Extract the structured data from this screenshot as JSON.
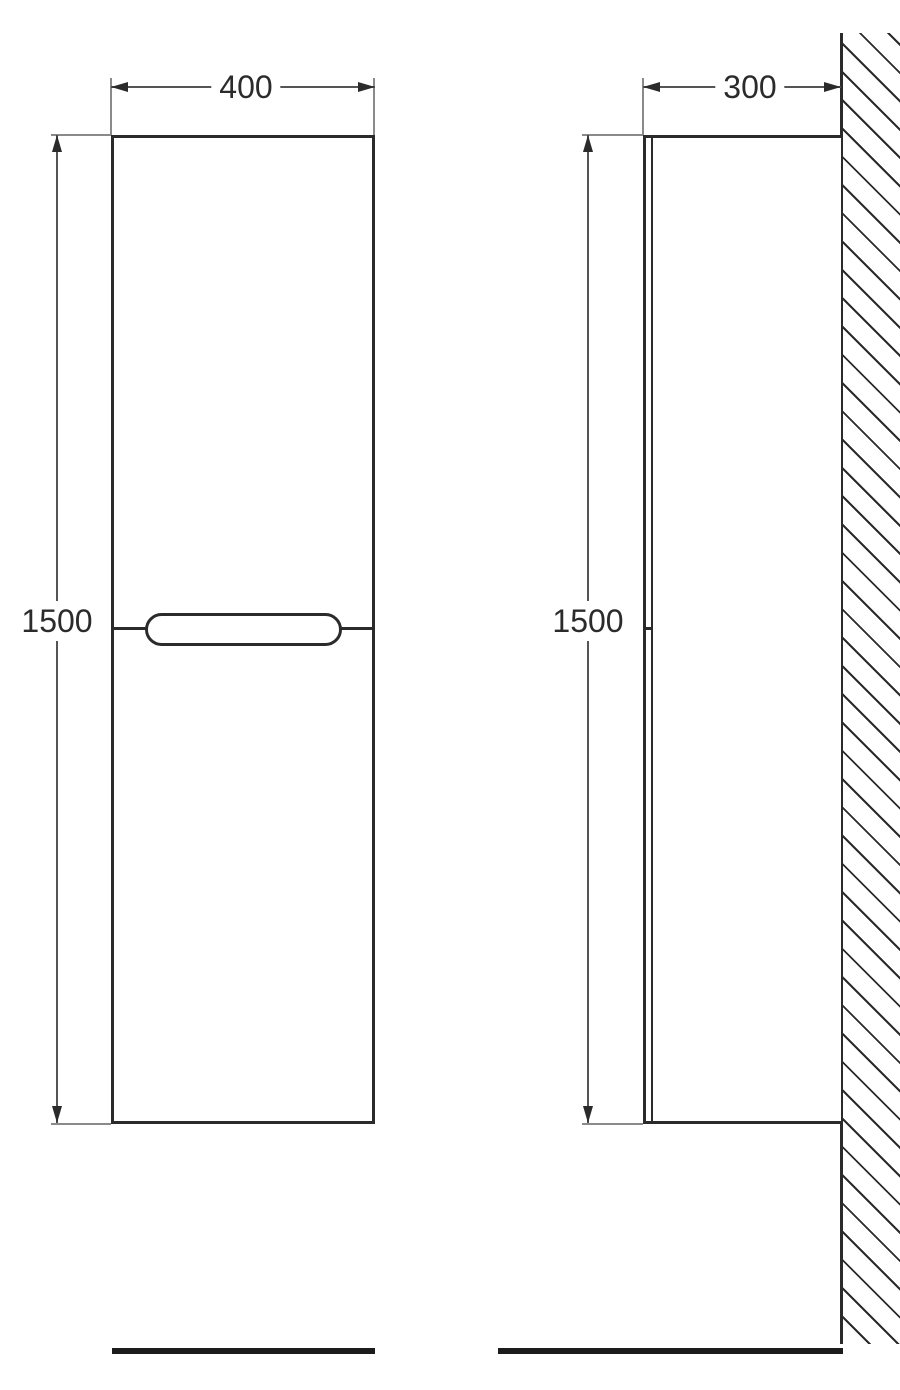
{
  "drawing": {
    "front_view": {
      "width_label": "400",
      "height_label": "1500"
    },
    "side_view": {
      "depth_label": "300",
      "height_label": "1500"
    },
    "colors": {
      "line_dark": "#2b2b2b",
      "dim_line": "#555555",
      "ext_line": "#8a8a8a",
      "floor": "#1c1c1c",
      "text": "#2b2b2b",
      "bg": "#ffffff"
    }
  }
}
